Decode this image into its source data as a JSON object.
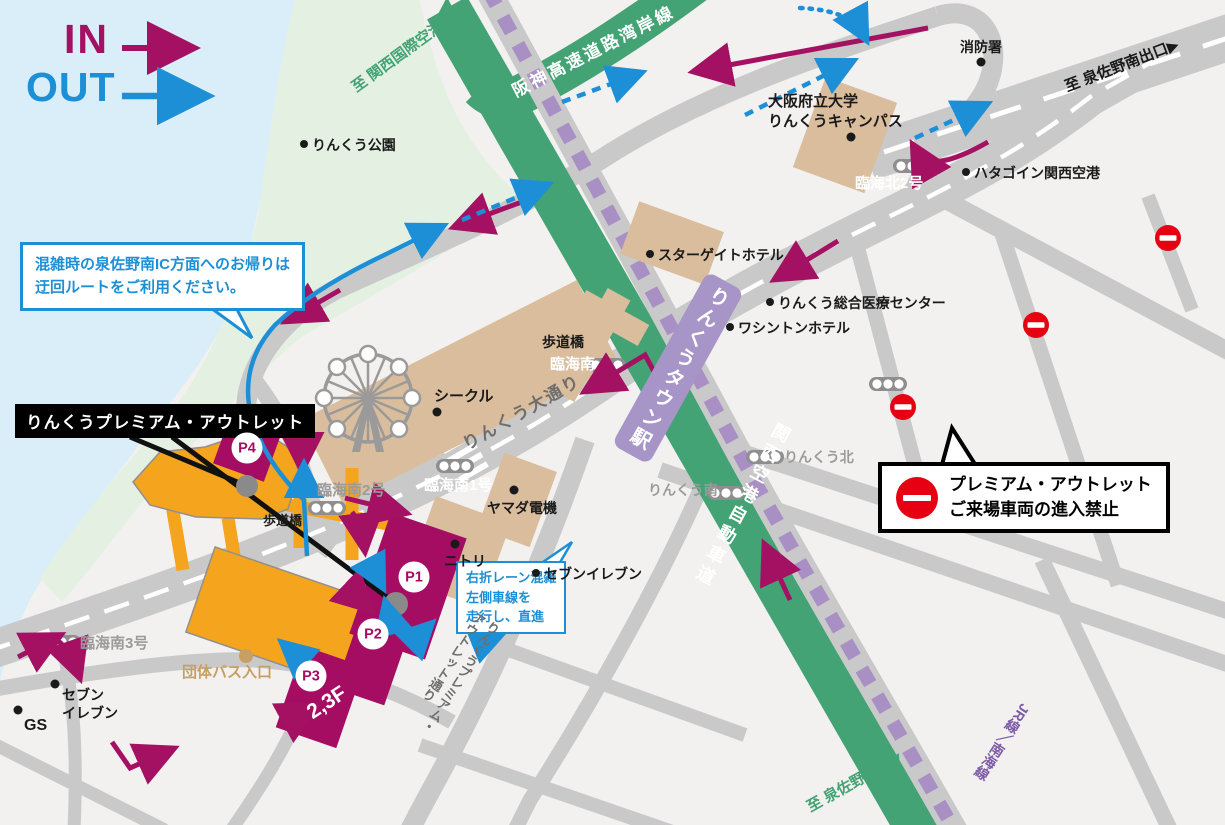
{
  "legend": {
    "in": "IN",
    "out": "OUT"
  },
  "icons": {
    "dir_right": "▶",
    "dir_down": "▼"
  },
  "colors": {
    "in_magenta": "#A41162",
    "out_blue": "#1C8FD6",
    "expressway_green": "#43A374",
    "rail_purple": "#A88FC4",
    "station_purple": "#A795C7",
    "parking_magenta": "#A50D63",
    "outlet_orange": "#F4A41D",
    "building_tan": "#D9BD9C",
    "road_gray": "#C9C9CA",
    "noentry_red": "#E60012",
    "water_blue": "#D9EEF8",
    "park_green": "#E4F1E2"
  },
  "callouts": {
    "detour": {
      "line1": "混雑時の泉佐野南IC方面へのお帰りは",
      "line2": "迂回ルートをご利用ください。"
    },
    "lane": {
      "line1": "右折レーン混雑",
      "line2": "左側車線を",
      "line3": "走行し、直進"
    },
    "no_entry": {
      "line1": "プレミアム・アウトレット",
      "line2": "ご来場車両の進入禁止"
    }
  },
  "outlet": {
    "name": "りんくうプレミアム・アウトレット"
  },
  "roads": {
    "hanshin": "阪神高速道路湾岸線",
    "kansai_airport_expwy": "関西空港自動車道",
    "rinku_odori": "りんくう大通り",
    "outlet_street_line1": "りんくうプレミアム・",
    "outlet_street_line2": "アウトレット通り",
    "jr_nankai": "JR線／南海線"
  },
  "destinations": {
    "kansai_airport": "至 関西国際空港",
    "izumisano_minami_exit": "至 泉佐野南出口",
    "izumisano_exit": "至 泉佐野出口"
  },
  "station": {
    "name": "りんくうタウン駅"
  },
  "intersections": {
    "rinkai_kita2": "臨海北2号",
    "rinkai_minami": "臨海南",
    "rinkai_minami1": "臨海南1号",
    "rinkai_minami2": "臨海南2号",
    "rinkai_minami3": "臨海南3号",
    "rinku_kita": "りんくう北",
    "rinku_minami": "りんくう南"
  },
  "pois": {
    "fire_station": "消防署",
    "univ_line1": "大阪府立大学",
    "univ_line2": "りんくうキャンパス",
    "hatago": "ハタゴイン関西空港",
    "rinku_park": "りんくう公園",
    "stargate": "スターゲイトホテル",
    "medical": "りんくう総合医療センター",
    "washington": "ワシントンホテル",
    "seacle": "シークル",
    "yamada": "ヤマダ電機",
    "nitori": "ニトリ",
    "seven1": "セブンイレブン",
    "seven2_line1": "セブン",
    "seven2_line2": "イレブン",
    "gs": "GS",
    "hodokyo1": "歩道橋",
    "hodokyo2": "歩道橋",
    "bus_entrance": "団体バス入口"
  },
  "parking": {
    "p1": "P1",
    "p2": "P2",
    "p3": "P3",
    "p4": "P4",
    "p3_floor": "2,3F"
  }
}
